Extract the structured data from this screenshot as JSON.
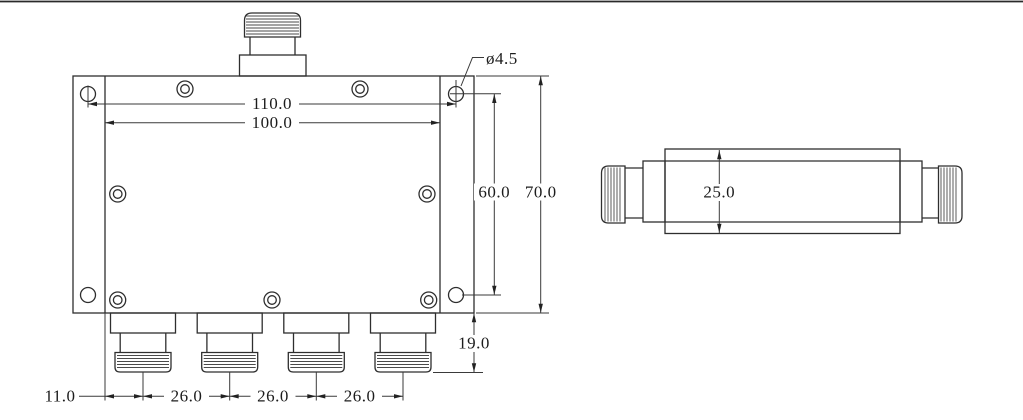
{
  "front_view": {
    "dims": {
      "hole_pitch_width": "110.0",
      "body_width": "100.0",
      "hole_pitch_height": "60.0",
      "plate_height": "70.0",
      "mount_hole_dia": "ø4.5",
      "port_protrusion": "19.0",
      "first_port_offset": "11.0",
      "port_pitch_1": "26.0",
      "port_pitch_2": "26.0",
      "port_pitch_3": "26.0"
    }
  },
  "side_view": {
    "dims": {
      "body_height": "25.0"
    }
  },
  "colors": {
    "background": "#ffffff",
    "outline": "#2e2e2e",
    "dimension_line": "#3a3a3a",
    "text": "#1c1c1c",
    "top_border": "#2a2a2a"
  }
}
